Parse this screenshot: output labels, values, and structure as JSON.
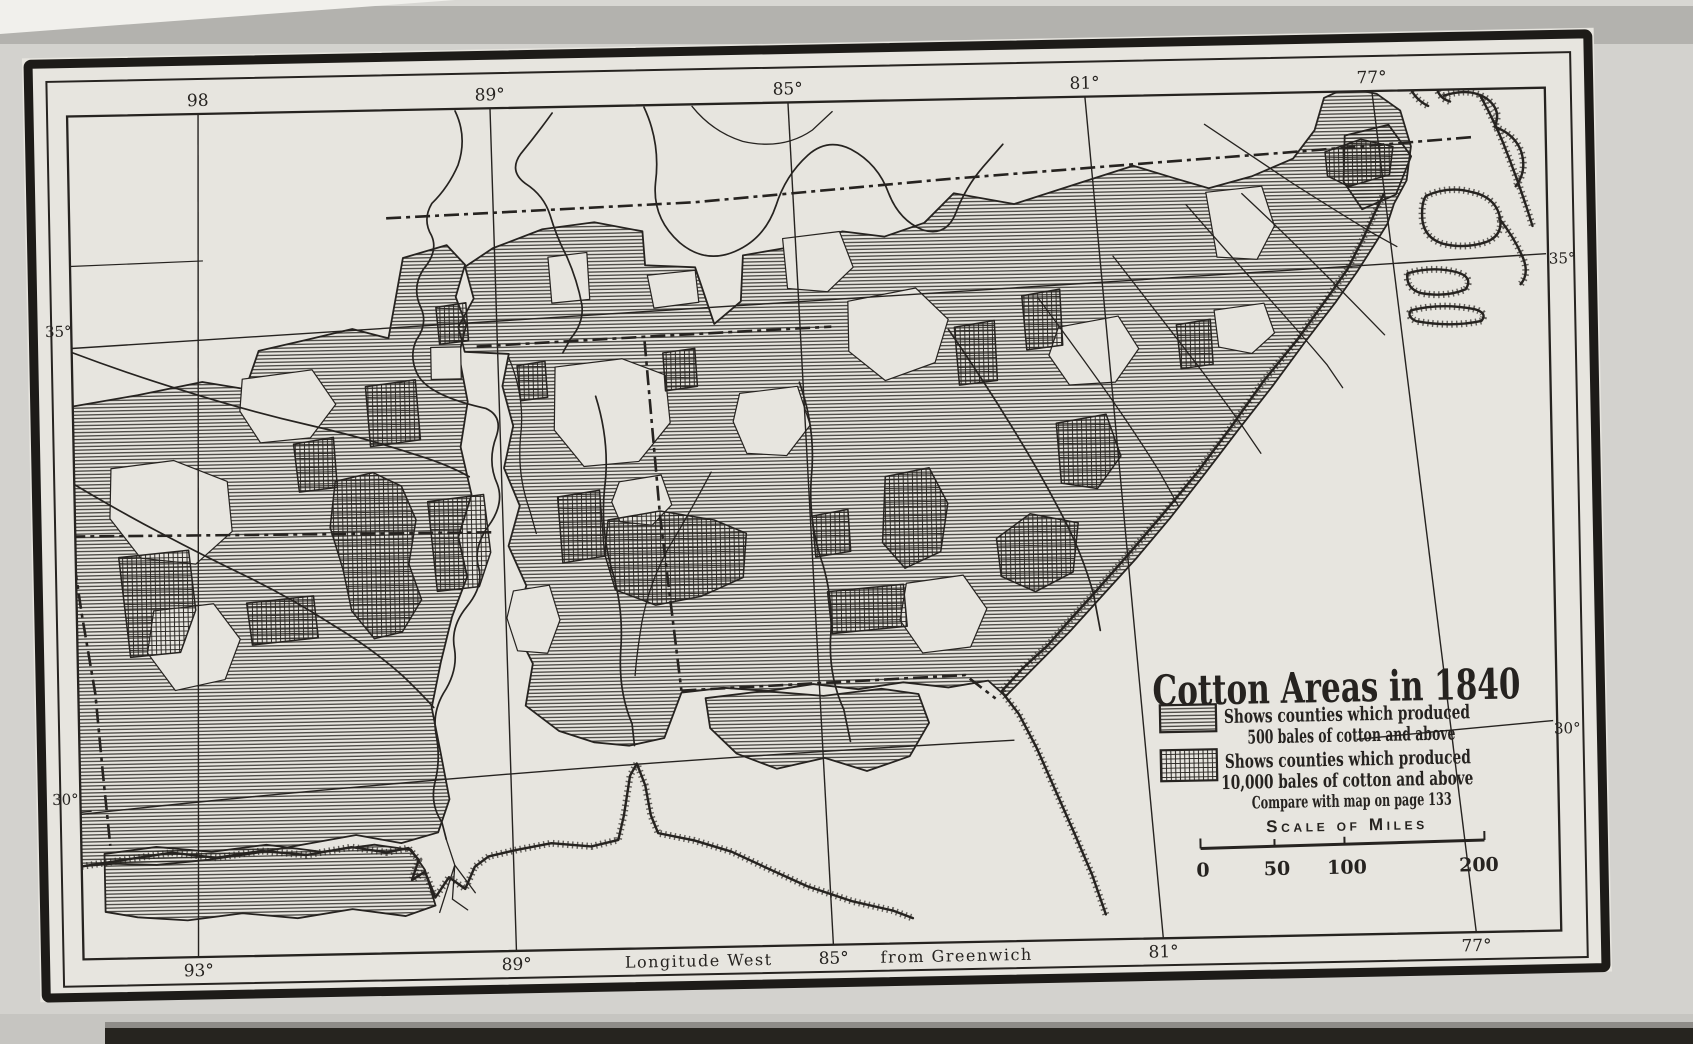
{
  "document": {
    "type": "Scanned historical map plate"
  },
  "map": {
    "title": "Cotton Areas in 1840",
    "legend": {
      "items": [
        {
          "swatch": "horizontal-hatch",
          "line1": "Shows counties which produced",
          "line2": "500 bales of cotton and above"
        },
        {
          "swatch": "crosshatch",
          "line1": "Shows counties which produced",
          "line2": "10,000 bales of cotton and above"
        }
      ],
      "note": "Compare with map on page 133"
    },
    "scale_bar": {
      "title": "Scale of Miles",
      "ticks": [
        "0",
        "50",
        "100",
        "200"
      ]
    },
    "graticule": {
      "top_labels": [
        "98",
        "89°",
        "85°",
        "81°",
        "77°"
      ],
      "bottom_labels": [
        "93°",
        "89°",
        "85°",
        "81°",
        "77°"
      ],
      "bottom_caption_left": "Longitude West",
      "bottom_caption_right": "from Greenwich",
      "left_labels": [
        "35°",
        "30°"
      ],
      "right_labels": [
        "35°",
        "30°"
      ]
    },
    "colors": {
      "ink": "#262320",
      "paper": "#e7e5df",
      "page": "#d3d2ce"
    }
  }
}
